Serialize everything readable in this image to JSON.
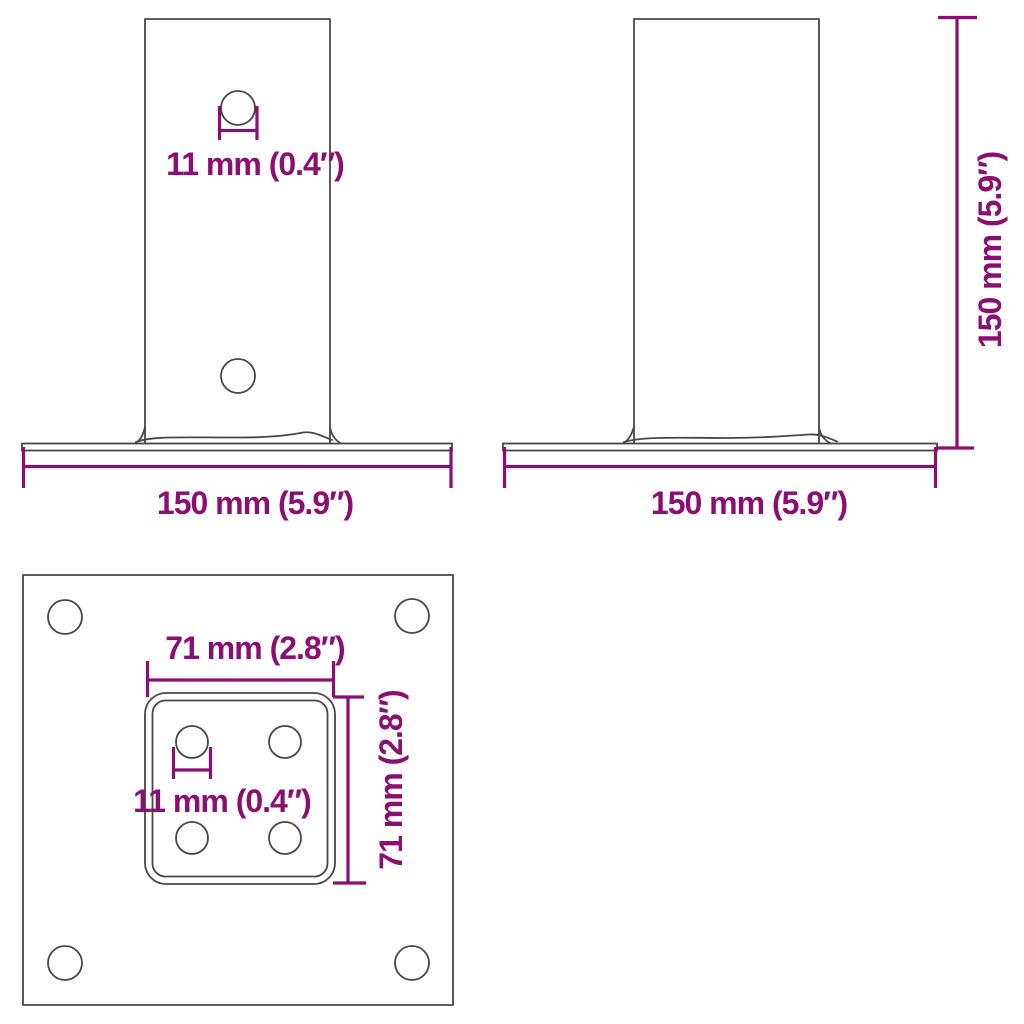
{
  "colors": {
    "dimension": "#8B0E72",
    "outline": "#474747",
    "background": "#ffffff"
  },
  "views": {
    "front": {
      "hole_diameter_label": "11 mm (0.4″)",
      "base_width_label": "150 mm (5.9″)"
    },
    "side": {
      "height_label": "150 mm (5.9″)",
      "base_width_label": "150 mm (5.9″)"
    },
    "top": {
      "inner_width_label": "71 mm (2.8″)",
      "inner_height_label": "71 mm (2.8″)",
      "hole_diameter_label": "11 mm (0.4″)"
    }
  }
}
